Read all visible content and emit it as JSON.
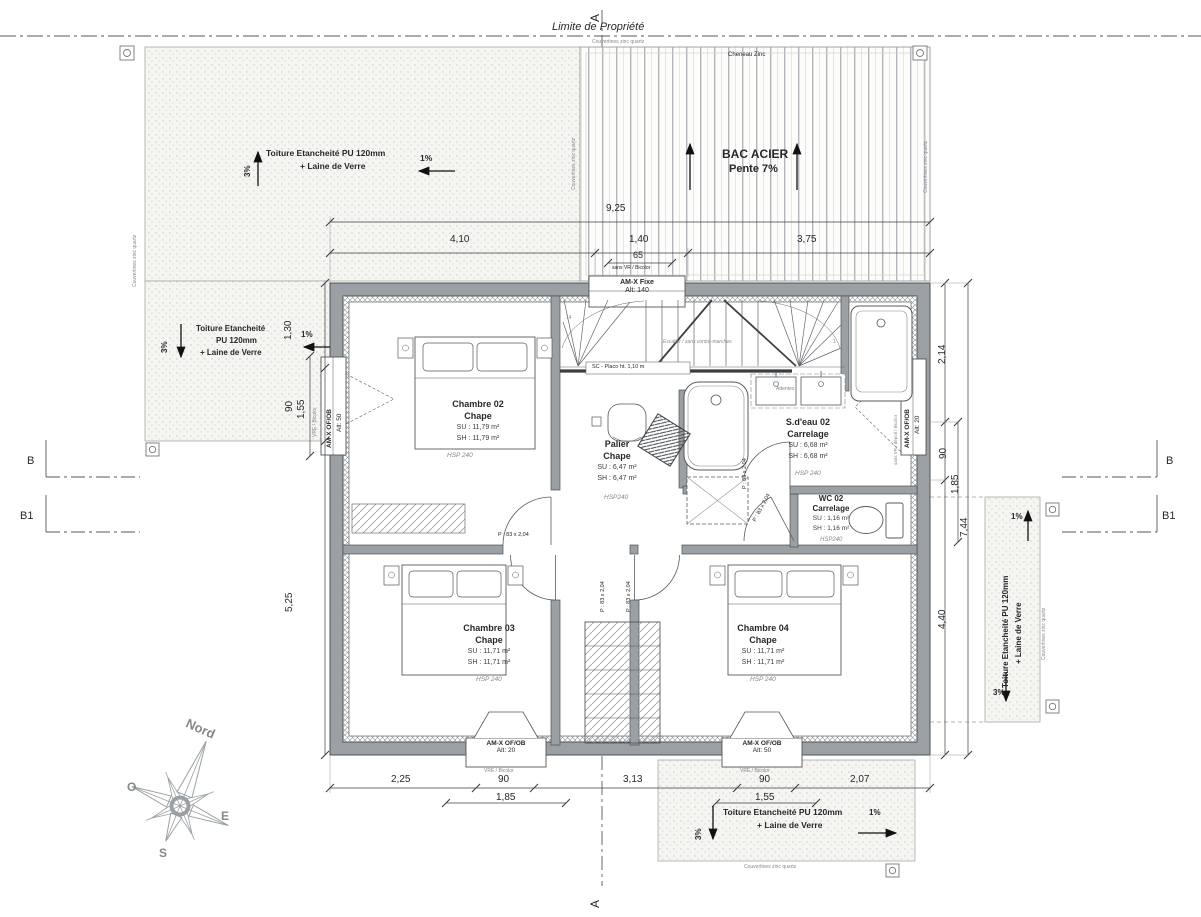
{
  "property_line_label": "Limite de Propriété",
  "markers": {
    "a": "A",
    "b": "B",
    "b1": "B1"
  },
  "compass": {
    "north": "Nord",
    "west": "O",
    "east": "E",
    "south": "S"
  },
  "annotations": {
    "couvertines": "Couvertines zinc quartz",
    "cheneau": "Cheneau Zinc",
    "sans_vr_bicolor": "sans VR / Bicolor",
    "sans_vr_depoli_bicolor": "sans VR / dépoli / Bicolor",
    "vre_bicolor": "VRE / Bicolor",
    "escalier": "Escalier / sans contre-marches",
    "sc_placo": "SC - Placo ht. 1,10 m",
    "attentes": "Attentes",
    "stair_first": "1",
    "stair_last": "14"
  },
  "roofs": {
    "top_left": {
      "slope_cross": "3%",
      "slope_long": "1%",
      "line1": "Toiture Etancheité PU 120mm",
      "line2": "+ Laine de Verre"
    },
    "left": {
      "slope_cross": "3%",
      "slope_long": "1%",
      "line1": "Toiture Etancheité",
      "line2": "PU 120mm",
      "line3": "+ Laine de Verre"
    },
    "bac_acier": {
      "line1": "BAC ACIER",
      "line2": "Pente 7%"
    },
    "right": {
      "slope_top": "1%",
      "slope_bottom": "3%",
      "line1": "Toiture Etancheité PU 120mm",
      "line2": "+ Laine de Verre"
    },
    "bottom": {
      "slope_cross": "3%",
      "slope_long": "1%",
      "line1": "Toiture Etancheité PU 120mm",
      "line2": "+ Laine de Verre"
    }
  },
  "windows": {
    "top": {
      "label": "AM-X Fixe",
      "alt": "Alt: 140"
    },
    "left": {
      "label": "AM-X OF/OB",
      "alt": "Alt: 50"
    },
    "right": {
      "label": "AM-X OF/OB",
      "alt": "Alt: 20"
    },
    "bottom_left": {
      "label": "AM-X OF/OB",
      "alt": "Alt: 20"
    },
    "bottom_right": {
      "label": "AM-X OF/OB",
      "alt": "Alt: 50"
    }
  },
  "door_label": "P : 83 x 2,04",
  "rooms": [
    {
      "name": "Chambre 02",
      "finish": "Chape",
      "su": "SU : 11,79 m²",
      "sh": "SH : 11,79 m²",
      "hsp": "HSP 240"
    },
    {
      "name": "Palier",
      "finish": "Chape",
      "su": "SU : 6,47 m²",
      "sh": "SH : 6,47 m²",
      "hsp": "HSP240"
    },
    {
      "name": "S.d'eau 02",
      "finish": "Carrelage",
      "su": "SU : 6,68 m²",
      "sh": "SH : 6,68 m²",
      "hsp": "HSP 240"
    },
    {
      "name": "WC 02",
      "finish": "Carrelage",
      "su": "SU : 1,16 m²",
      "sh": "SH : 1,16 m²",
      "hsp": "HSP240"
    },
    {
      "name": "Chambre 03",
      "finish": "Chape",
      "su": "SU : 11,71 m²",
      "sh": "SH : 11,71 m²",
      "hsp": "HSP 240"
    },
    {
      "name": "Chambre 04",
      "finish": "Chape",
      "su": "SU : 11,71 m²",
      "sh": "SH : 11,71 m²",
      "hsp": "HSP 240"
    }
  ],
  "dimensions": {
    "top": [
      "9,25",
      "4,10",
      "1,40",
      "3,75",
      "65"
    ],
    "bottom": [
      "2,25",
      "90",
      "3,13",
      "90",
      "2,07",
      "1,85",
      "1,55"
    ],
    "left": [
      "1,30",
      "90",
      "1,55",
      "5,25"
    ],
    "right": [
      "2,14",
      "90",
      "1,85",
      "7,44",
      "4,40"
    ]
  }
}
